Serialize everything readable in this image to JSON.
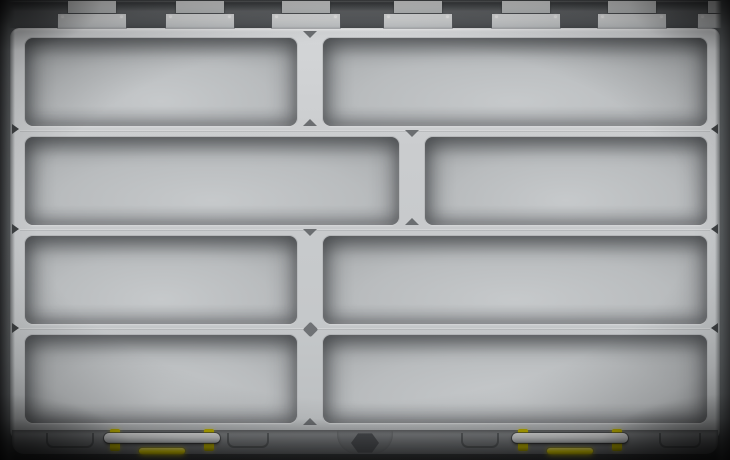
{
  "scene": {
    "object_label": "plastic-parts-organizer-case",
    "view": "top-down, lid open/removed, all compartments empty",
    "counts": {
      "compartments": 8,
      "hinges": 6,
      "latches": 2
    },
    "colors": {
      "tray_light": "#cdd0d2",
      "well_shadow": "#8e9193",
      "well_floor": "#c6c9cb",
      "rail_gray": "#85888b",
      "hinge_metal": "#e6e8e9",
      "latch_bar_white": "#ffffff",
      "latch_yellow": "#f4e500",
      "edge_dark": "#3a3c3e"
    },
    "hinges": [
      {
        "x": 58,
        "w": 68
      },
      {
        "x": 166,
        "w": 68
      },
      {
        "x": 272,
        "w": 68
      },
      {
        "x": 384,
        "w": 68
      },
      {
        "x": 492,
        "w": 68
      },
      {
        "x": 598,
        "w": 68
      },
      {
        "x": 698,
        "w": 50
      }
    ],
    "compartments": [
      {
        "id": "r1c1",
        "x": 25,
        "y": 38,
        "w": 272,
        "h": 88
      },
      {
        "id": "r1c2",
        "x": 323,
        "y": 38,
        "w": 384,
        "h": 88
      },
      {
        "id": "r2c1",
        "x": 25,
        "y": 137,
        "w": 374,
        "h": 88
      },
      {
        "id": "r2c2",
        "x": 425,
        "y": 137,
        "w": 282,
        "h": 88
      },
      {
        "id": "r3c1",
        "x": 25,
        "y": 236,
        "w": 272,
        "h": 88
      },
      {
        "id": "r3c2",
        "x": 323,
        "y": 236,
        "w": 384,
        "h": 88
      },
      {
        "id": "r4c1",
        "x": 25,
        "y": 335,
        "w": 272,
        "h": 88
      },
      {
        "id": "r4c2",
        "x": 323,
        "y": 335,
        "w": 384,
        "h": 88
      }
    ],
    "row_seams": [
      130,
      229,
      328
    ],
    "divider_triangles": [
      {
        "x": 310,
        "y": 31,
        "dir": "down"
      },
      {
        "x": 310,
        "y": 119,
        "dir": "up"
      },
      {
        "x": 412,
        "y": 130,
        "dir": "down"
      },
      {
        "x": 412,
        "y": 218,
        "dir": "up"
      },
      {
        "x": 310,
        "y": 229,
        "dir": "down"
      },
      {
        "x": 310,
        "y": 418,
        "dir": "up"
      }
    ],
    "diamonds": [
      {
        "x": 310,
        "y": 329
      }
    ],
    "edge_notches": [
      {
        "side": "left",
        "y": 129
      },
      {
        "side": "left",
        "y": 229
      },
      {
        "side": "left",
        "y": 328
      },
      {
        "side": "right",
        "y": 129
      },
      {
        "side": "right",
        "y": 229
      },
      {
        "side": "right",
        "y": 328
      }
    ],
    "rail_tabs": [
      {
        "x": 46,
        "w": 44
      },
      {
        "x": 227,
        "w": 38
      },
      {
        "x": 461,
        "w": 34
      },
      {
        "x": 659,
        "w": 38
      }
    ],
    "latches": [
      {
        "x": 102,
        "w": 120
      },
      {
        "x": 510,
        "w": 120
      }
    ],
    "hex_tab": {
      "x": 337,
      "w": 56
    }
  }
}
